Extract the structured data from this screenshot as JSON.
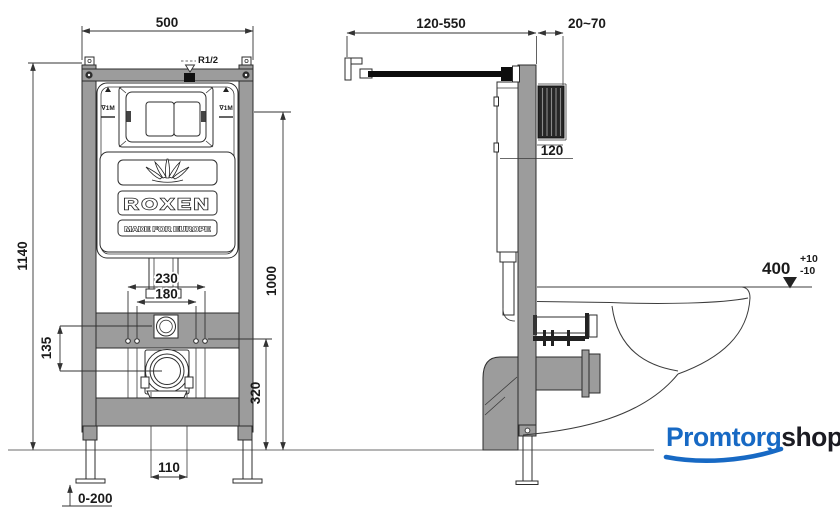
{
  "drawing": {
    "front": {
      "dim_width": "500",
      "dim_height": "1140",
      "inlet_label": "R1/2",
      "level_mark_left": "∇1M",
      "level_mark_right": "∇1M",
      "dim_bolt_outer": "230",
      "dim_bolt_inner": "180",
      "dim_panel_height": "1000",
      "dim_supply_offset": "135",
      "dim_outlet_height": "320",
      "dim_outlet_pipe": "110",
      "dim_feet_adjust": "0-200",
      "brand": "ROXEN",
      "brand_tagline": "MADE FOR EUROPE"
    },
    "side": {
      "dim_rod_length": "120-550",
      "dim_wall_gap": "20~70",
      "dim_frame_depth": "120",
      "dim_rim_height": "400",
      "dim_rim_tol_plus": "+10",
      "dim_rim_tol_minus": "-10"
    }
  },
  "watermark": {
    "brand_blue": "Promtorg",
    "brand_dark": "shop"
  },
  "colors": {
    "frame_gray": "#9c9c9c",
    "line_dark": "#2e2e2e",
    "logo_blue": "#1769c4",
    "logo_dark": "#1b1b22",
    "wall_dark": "#262626"
  }
}
